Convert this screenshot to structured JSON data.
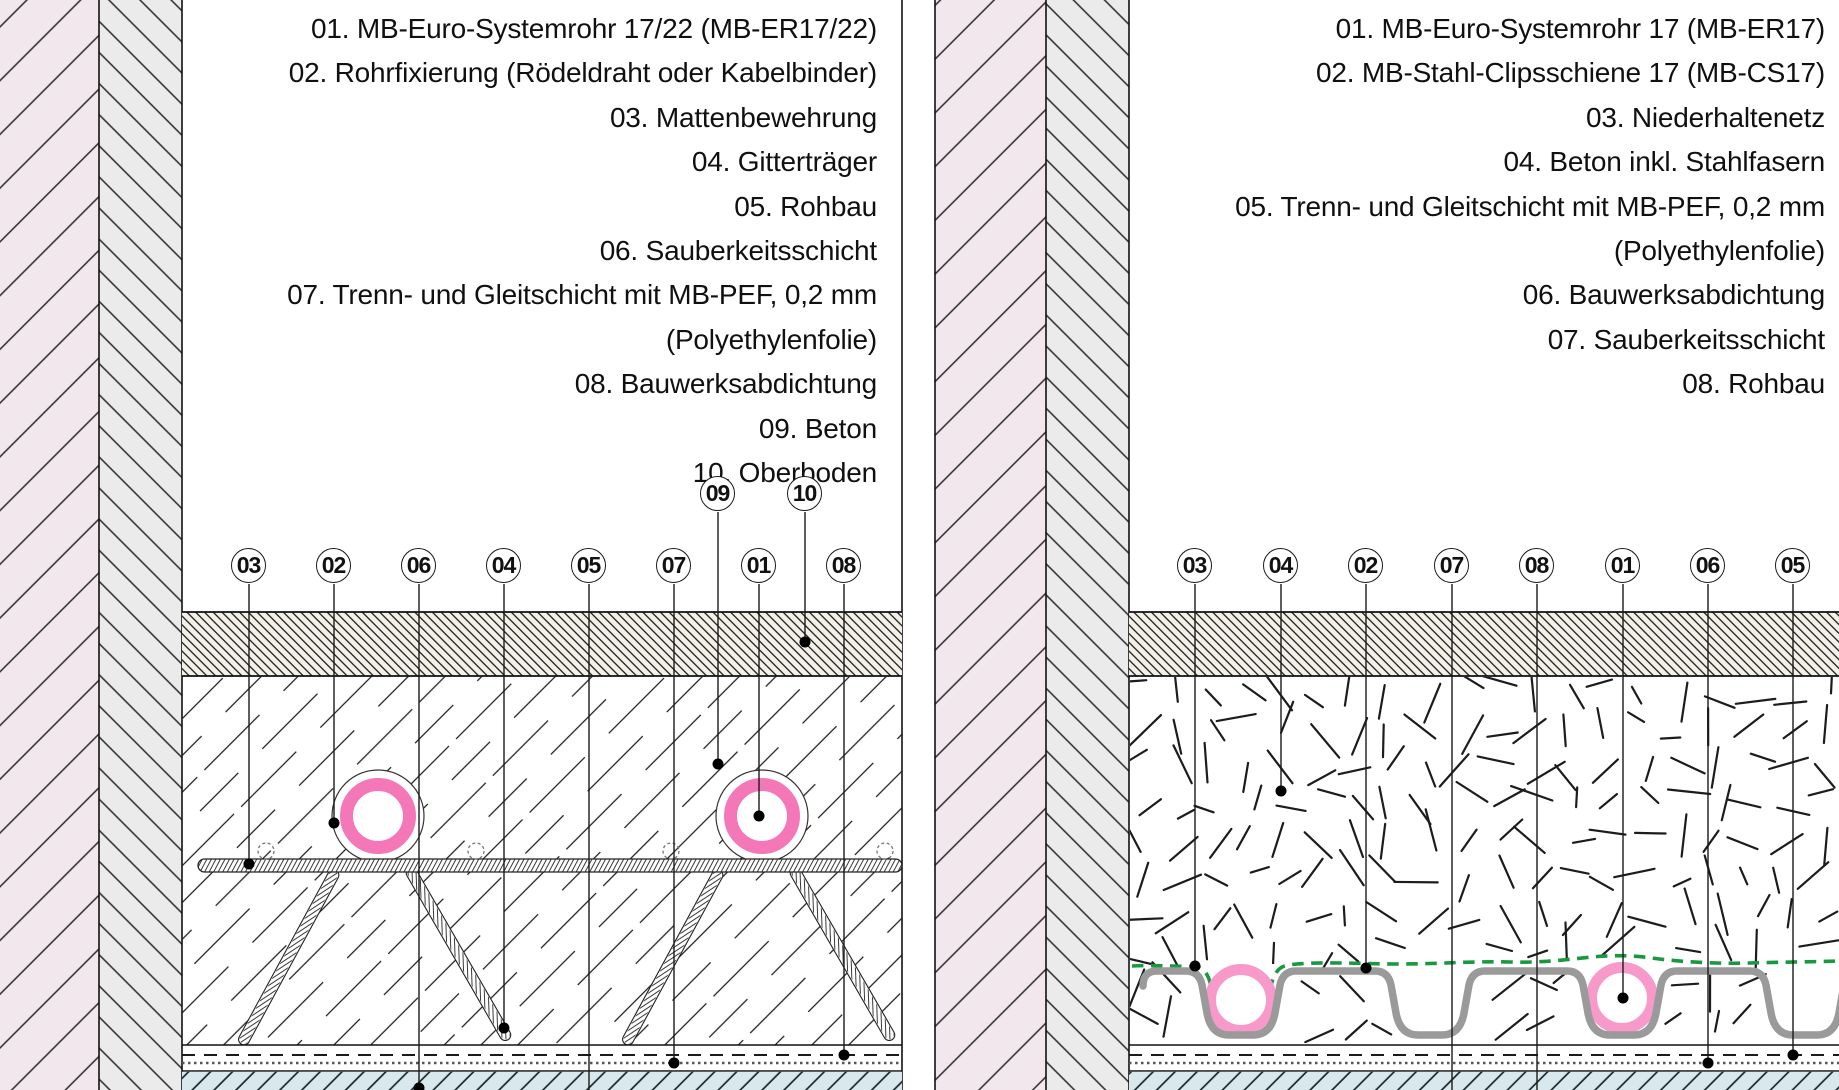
{
  "left_panel": {
    "legend": [
      "01. MB-Euro-Systemrohr 17/22 (MB-ER17/22)",
      "02. Rohrfixierung (Rödeldraht oder Kabelbinder)",
      "03. Mattenbewehrung",
      "04. Gitterträger",
      "05. Rohbau",
      "06. Sauberkeitsschicht",
      "07. Trenn- und Gleitschicht mit MB-PEF, 0,2 mm",
      "(Polyethylenfolie)",
      "08. Bauwerksabdichtung",
      "09. Beton",
      "10. Oberboden"
    ],
    "callout_row": [
      "03",
      "02",
      "06",
      "04",
      "05",
      "07",
      "01",
      "08"
    ],
    "callout_upper": [
      "09",
      "10"
    ]
  },
  "right_panel": {
    "legend": [
      "01. MB-Euro-Systemrohr 17 (MB-ER17)",
      "02. MB-Stahl-Clipsschiene 17 (MB-CS17)",
      "03. Niederhaltenetz",
      "04. Beton inkl. Stahlfasern",
      "05. Trenn- und Gleitschicht mit MB-PEF, 0,2 mm",
      "(Polyethylenfolie)",
      "06. Bauwerksabdichtung",
      "07. Sauberkeitsschicht",
      "08. Rohbau"
    ],
    "callout_row": [
      "03",
      "04",
      "02",
      "07",
      "08",
      "01",
      "06",
      "05"
    ]
  },
  "colors": {
    "pipe_pink_left": "#F478B8",
    "pipe_pink_right": "#F79AC9",
    "holding_net_green": "#18993F",
    "clip_rail_gray": "#9A9A9A",
    "wall_plaster_pink": "#F3E7EE",
    "wall_concrete_gray": "#EBEBEB",
    "screed_beige": "#F3F0E8",
    "blinding_layer_blue": "#D8E8EC"
  }
}
